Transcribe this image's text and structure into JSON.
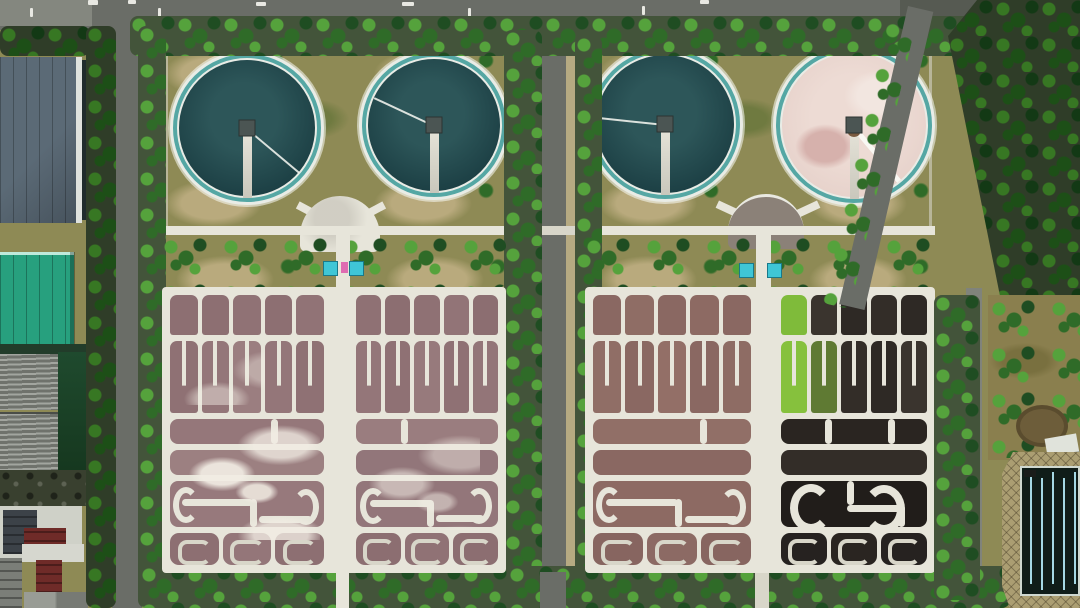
{
  "scene": {
    "description": "Aerial top-down photo of a wastewater treatment plant: four circular clarifier tanks at top, two large gridded aeration basin blocks below, tree-lined roads, industrial buildings on the left edge, a serpentine contact pool at bottom right",
    "clarifier_count": 4,
    "basin_block_count": 2
  },
  "palette": {
    "grass": "#8e8a55",
    "grass_patch": "#b9aa7d",
    "grass_dark": "#6f7a40",
    "soil": "#43543a",
    "tree_dark": "#1f4d22",
    "tree_mid": "#2f6b28",
    "tree_bright": "#55a23c",
    "road": "#6a6d67",
    "road_dark": "#565a52",
    "sidewalk": "#b6aa82",
    "concrete": "#e7e5da",
    "concrete_dim": "#d8d6c9",
    "ring_white": "#e9ece6",
    "teal_ring": "#55a7a4",
    "water_edge": "#1b3e43",
    "water_mid": "#2d5659",
    "pink_surface": "#e6d1ca",
    "pink_blotch": "#d6b1ac",
    "maroon": "#6f2b28",
    "teal_roof": "#27a07e",
    "slate": "#5b6a76",
    "slate_dark": "#46525c",
    "bank": "#ab9e72",
    "pool": "#101d19",
    "lane": "#a5d8e4",
    "teal_box": "#3fc6d6",
    "pink_box": "#df6cb2",
    "dark_forest": "#1d3b1e",
    "field": "#8a7f4e",
    "platform_gray": "#8b8178"
  },
  "clarifiers": [
    {
      "surface": "dark-water",
      "arm_deg": 40
    },
    {
      "surface": "dark-water",
      "arm_deg": 205
    },
    {
      "surface": "dark-water",
      "arm_deg": 186
    },
    {
      "surface": "pink-scum",
      "arm_deg": 50
    }
  ],
  "basins": {
    "halfA": {
      "row1": [
        "#8d6f72",
        "#8d6f72",
        "#907275",
        "#8d6f72",
        "#917376"
      ],
      "row2": [
        "#8f7174",
        "#947679",
        "#9b7e80",
        "#947679",
        "#8f7174"
      ],
      "mid": [
        "#95777a",
        "#9c8081"
      ],
      "mid0": "#95777a",
      "mid1": "#9c8081",
      "maze": "#97797c",
      "bottom": [
        "#8d6f72",
        "#947679",
        "#8d6f72"
      ]
    },
    "halfB": {
      "row1": [
        "#8f7174",
        "#8c6e71",
        "#8f7174",
        "#927477",
        "#8c6e71"
      ],
      "row2": [
        "#947679",
        "#8f7174",
        "#977a7c",
        "#8f7174",
        "#937578"
      ],
      "mid0": "#9a7d7f",
      "mid1": "#92767a",
      "maze": "#93767a",
      "bottom": [
        "#8c6e71",
        "#907275",
        "#8c6e71"
      ]
    },
    "halfC": {
      "row1": [
        "#8a6862",
        "#8f6d65",
        "#8a6862",
        "#8d6a63",
        "#8a6862"
      ],
      "row2": [
        "#906e66",
        "#8a6862",
        "#936f67",
        "#8a6862",
        "#8e6c64"
      ],
      "mid0": "#916f67",
      "mid1": "#8a6862",
      "maze": "#8d6a63",
      "bottom": [
        "#876560",
        "#8c6a64",
        "#876560"
      ]
    },
    "halfD": {
      "row1": [
        "#7fbb3a",
        "#3a342e",
        "#2e2925",
        "#332d28",
        "#2e2925"
      ],
      "row2": [
        "#86c13d",
        "#5f7a33",
        "#332d28",
        "#2e2925",
        "#3a342e"
      ],
      "mid0": "#2a2521",
      "mid1": "#332d28",
      "maze": "#211d1a",
      "bottom": [
        "#262220",
        "#2a2521",
        "#262220"
      ]
    }
  },
  "contact_pool": {
    "lane_count": 5,
    "water_color": "#101d19",
    "lane_color": "#a5d8e4"
  },
  "equipment_markers": {
    "teal_box_count": 4,
    "pink_marker_count": 1
  }
}
